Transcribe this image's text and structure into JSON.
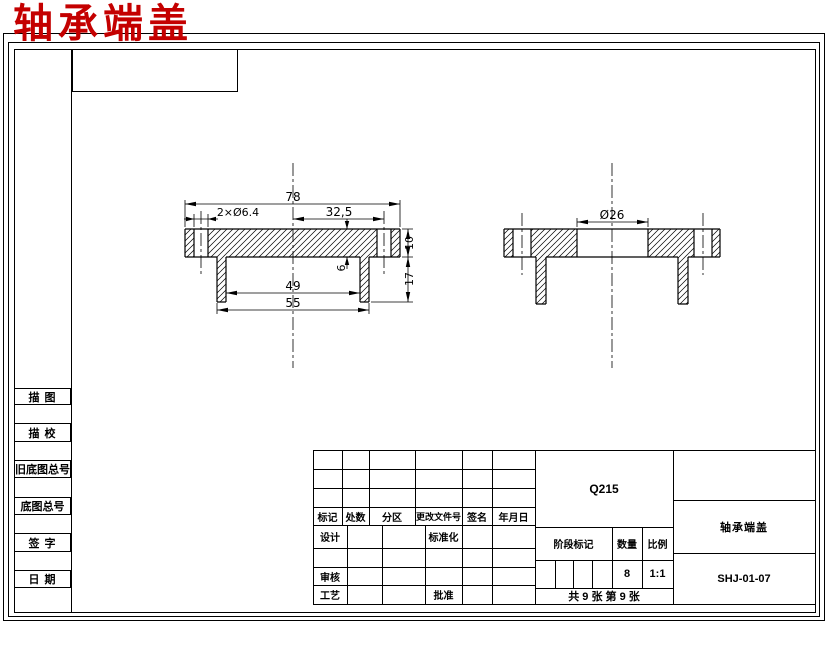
{
  "doc_title": "轴承端盖",
  "sidebar": {
    "items": [
      "描 图",
      "描 校",
      "旧底图总号",
      "底图总号",
      "签 字",
      "日 期"
    ]
  },
  "views": {
    "left": {
      "overall_width": "78",
      "bolt_holes": "2×Ø6.4",
      "hole_offset": "32,5",
      "plate_thickness": "10",
      "total_height": "17",
      "recess_depth": "6",
      "inner_width": "49",
      "boss_width": "55"
    },
    "right": {
      "bore_diameter": "Ø26"
    }
  },
  "title_block": {
    "rev_headers": [
      "标记",
      "处数",
      "分区",
      "更改文件号",
      "签名",
      "年月日"
    ],
    "design_label": "设计",
    "standardization_label": "标准化",
    "review_label": "审核",
    "process_label": "工艺",
    "approve_label": "批准",
    "material": "Q215",
    "stage_mark_label": "阶段标记",
    "quantity_label": "数量",
    "scale_label": "比例",
    "quantity_value": "8",
    "scale_value": "1:1",
    "sheet_info": "共 9 张  第 9 张",
    "part_name": "轴承端盖",
    "drawing_number": "SHJ-01-07"
  }
}
